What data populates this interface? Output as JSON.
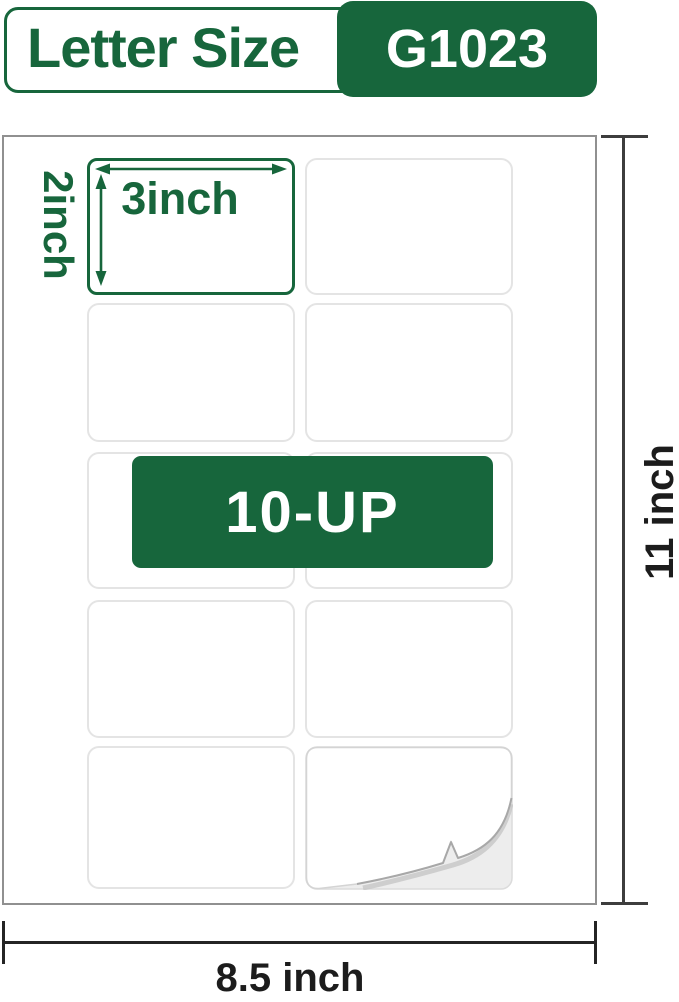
{
  "header": {
    "size_label": "Letter Size",
    "product_code": "G1023"
  },
  "diagram": {
    "label_width": "3inch",
    "label_height": "2inch",
    "count_banner": "10-UP",
    "sheet_width": "8.5 inch",
    "sheet_height": "11 inch",
    "grid": {
      "rows": 5,
      "columns": 2
    }
  },
  "colors": {
    "brand_green": "#17663C",
    "dimension_line": "#242424",
    "sheet_border": "#909090",
    "cell_border": "#e4e4e4"
  }
}
